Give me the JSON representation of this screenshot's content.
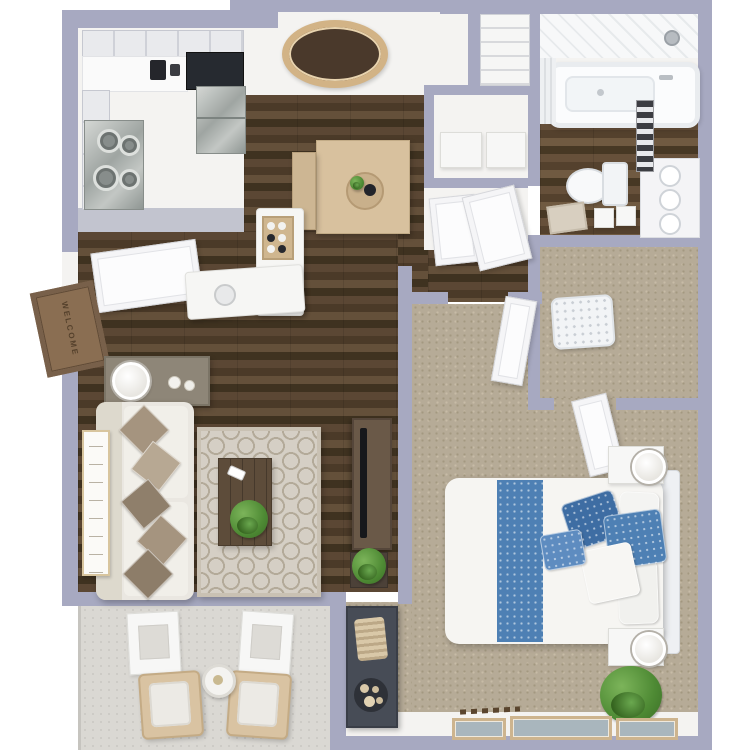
{
  "entry": {
    "doormat_text": "WELCOME"
  },
  "palette": {
    "background": "#ffffff",
    "wall": "#a7a9c1",
    "wall_light": "#c2c4cf",
    "wood_dark": "#4b3a28",
    "wood_mid": "#5b4734",
    "wood_light": "#64503a",
    "carpet": "#b6ab97",
    "concrete": "#dad8d3",
    "rug_base": "#d5cfc5",
    "rug_line": "#b3aa99",
    "sofa": "#eae7e1",
    "pillow_taupe": "#a5947f",
    "pillow_taupe_dark": "#8f7f6b",
    "accent_blue": "#4e80b4",
    "accent_blue_dark": "#3e6da3",
    "accent_blue_light": "#5e8cc0",
    "table_wood": "#d8c19e",
    "bench_wood": "#cdb693",
    "gold": "#d2b386",
    "mirror_glass": "#4a392b",
    "dark_counter": "#262a30",
    "stainless": "#aab0ad",
    "console_wood": "#6a5948",
    "coffee_table_wood": "#5d4c3a",
    "dresser_dark": "#474c56",
    "plant_green": "#4e8a34",
    "mat_brown": "#8a6e52",
    "white_surface": "#f4f3f1",
    "door_white": "#fcfcfd",
    "cabinet": "#e9eaed",
    "tub_white": "#fbfcfd",
    "chair_wood": "#d9c3a2"
  }
}
